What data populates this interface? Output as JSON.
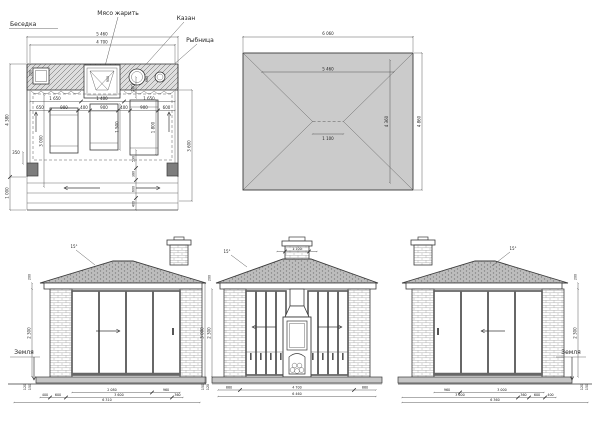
{
  "plan": {
    "name": "Беседка",
    "callouts": {
      "grill": "Мясо жарить",
      "kazan": "Казан",
      "fish": "Рыбница"
    },
    "dims": {
      "top_outer": "5 460",
      "top_inner": "4 700",
      "left_upper": "4 380",
      "left_lower": "1 000",
      "right": "3 600",
      "left_inner": "3 000",
      "row1": [
        "1 650",
        "1 400",
        "1 650"
      ],
      "row2": [
        "650",
        "900",
        "400",
        "900",
        "400",
        "900",
        "600"
      ],
      "bench_mid": "1 500",
      "bench_right": "1 800",
      "kazan_offset": "700",
      "wall_small": "350",
      "counter": [
        "200",
        "900",
        "660"
      ],
      "bottom_stack": [
        "590",
        "380",
        "600",
        "400"
      ]
    }
  },
  "roof_plan": {
    "dims": {
      "width_outer": "6 060",
      "width_inner": "5 460",
      "ridge": "1 100",
      "depth_inner": "4 360",
      "depth_outer": "4 860"
    }
  },
  "elevations": {
    "slope": "15°",
    "ground": "Земля",
    "left": {
      "height": "2 300",
      "fascia": "200",
      "base": [
        "120",
        "150"
      ],
      "row1": [
        "2 080",
        "960"
      ],
      "row2": [
        "400",
        "600",
        "3 600",
        "360"
      ],
      "total": "6 310"
    },
    "center": {
      "chimney_width": "1 100",
      "height_outer": "3 000",
      "height_inner": "2 300",
      "fascia": "200",
      "base": [
        "150",
        "120"
      ],
      "row1": [
        "880",
        "4 700",
        "880"
      ],
      "total": "6 460"
    },
    "right": {
      "height": "2 300",
      "fascia": "200",
      "base": [
        "120",
        "150"
      ],
      "row1": [
        "960",
        "3 000"
      ],
      "row2": [
        "3 600",
        "360",
        "600",
        "400"
      ],
      "total": "6 360"
    }
  },
  "colors": {
    "line": "#3a3a3a",
    "roof_fill": "#cbcbcb",
    "tile_fill": "#bdbdbd",
    "slab_fill": "#c6c6c6",
    "column_fill": "#7d7d7d"
  }
}
